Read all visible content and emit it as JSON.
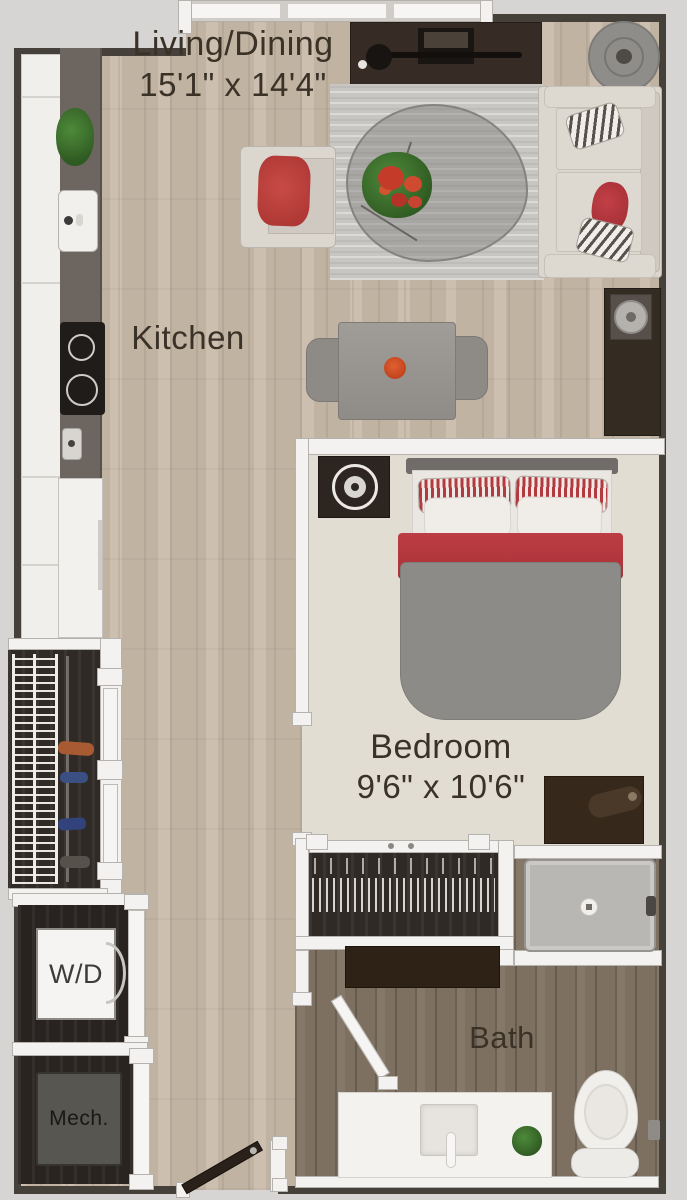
{
  "rooms": {
    "living": {
      "name": "Living/Dining",
      "dims": "15'1\" x 14'4\""
    },
    "kitchen": {
      "name": "Kitchen"
    },
    "bedroom": {
      "name": "Bedroom",
      "dims": "9'6\" x 10'6\""
    },
    "bath": {
      "name": "Bath"
    },
    "laundry": {
      "label": "W/D"
    },
    "mech": {
      "label": "Mech."
    }
  },
  "colors": {
    "background": "#d7d5d3",
    "wood_floor": "#c8baa8",
    "bath_floor": "#7d7060",
    "carpet": "#e2ddd3",
    "wall_white": "#f3f2f0",
    "wall_dark": "#46403b",
    "closet_dark": "#2f2a25",
    "accent_red": "#b5383e",
    "label_text": "#3a3127"
  },
  "furniture": [
    "sofa",
    "armchair",
    "rug",
    "coffee-table",
    "flowers",
    "tv-console",
    "side-table",
    "dining-table",
    "dining-chairs",
    "kitchen-counter",
    "kitchen-sink",
    "stove",
    "refrigerator",
    "plant",
    "bed",
    "nightstand",
    "lamp",
    "dresser",
    "closet-hangers",
    "washer-dryer",
    "mechanical-unit",
    "shower",
    "vanity",
    "bathroom-sink",
    "toilet",
    "entry-door",
    "bathroom-door",
    "window"
  ]
}
